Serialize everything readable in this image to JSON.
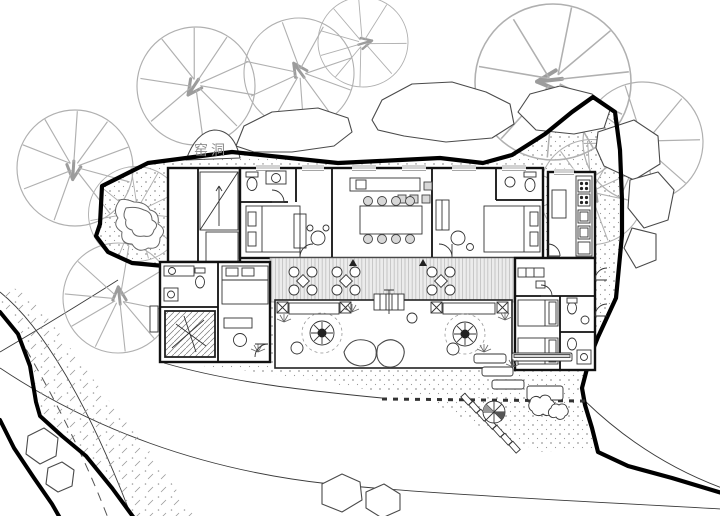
{
  "plan": {
    "area_label": "窑洞",
    "colors": {
      "ink": "#222222",
      "wall": "#111111",
      "boundary": "#000000",
      "tree": "#b0b0b0",
      "rock": "#4a4a4a",
      "stipple": "#9a9a9a",
      "deck-line": "#bdbdbd",
      "deck-bg": "#ececec",
      "label": "#8d8d8d",
      "paper": "#ffffff"
    }
  }
}
